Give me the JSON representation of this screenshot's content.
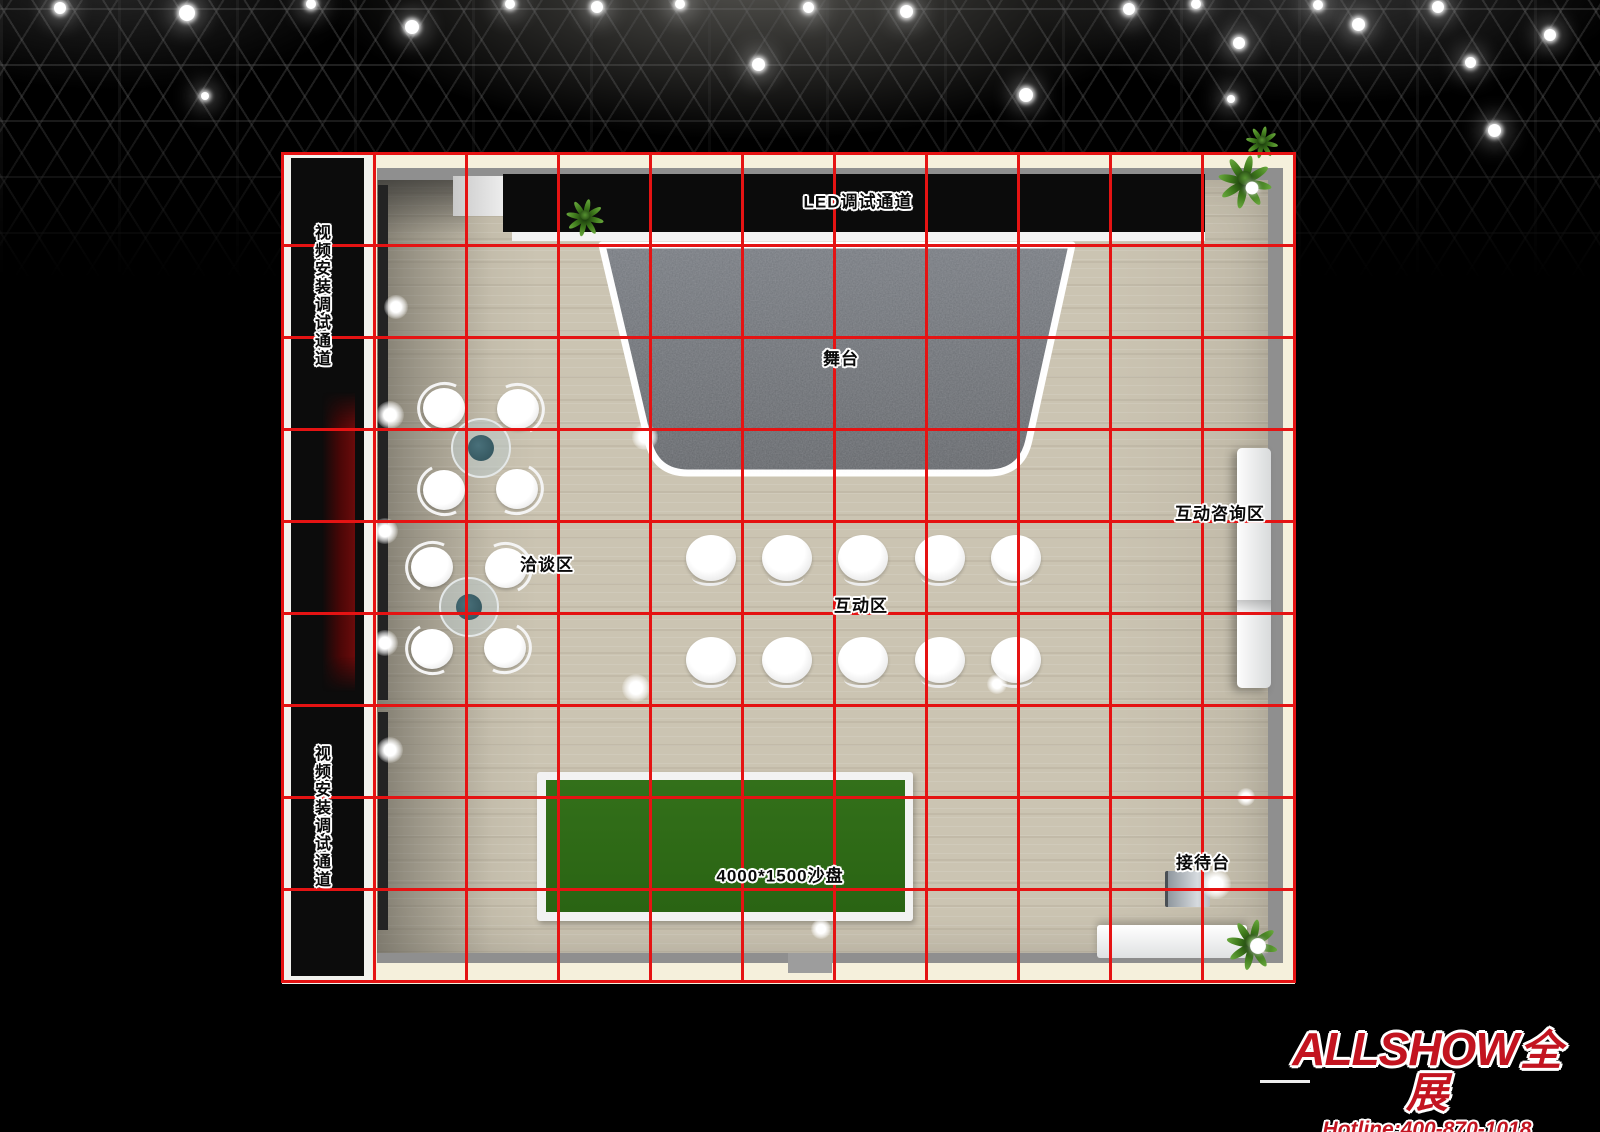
{
  "zones": {
    "led_channel": "LED调试通道",
    "video_channel": "视频安装调试通道",
    "stage": "舞台",
    "negotiation": "洽谈区",
    "interaction": "互动区",
    "consultation": "互动咨询区",
    "sand_table": "4000*1500沙盘",
    "reception": "接待台"
  },
  "branding": {
    "logo_text": "ALLSHOW",
    "logo_suffix": "全展",
    "hotline": "Hotline:400-870-1018"
  },
  "colors": {
    "grid_red": "#e51313",
    "sand_green": "#2e6a16",
    "stage_gray": "#6d7177",
    "floor_wood": "#cbc4b2",
    "logo_red": "#c31420",
    "channel_glow_red": "#5d0a0a"
  }
}
